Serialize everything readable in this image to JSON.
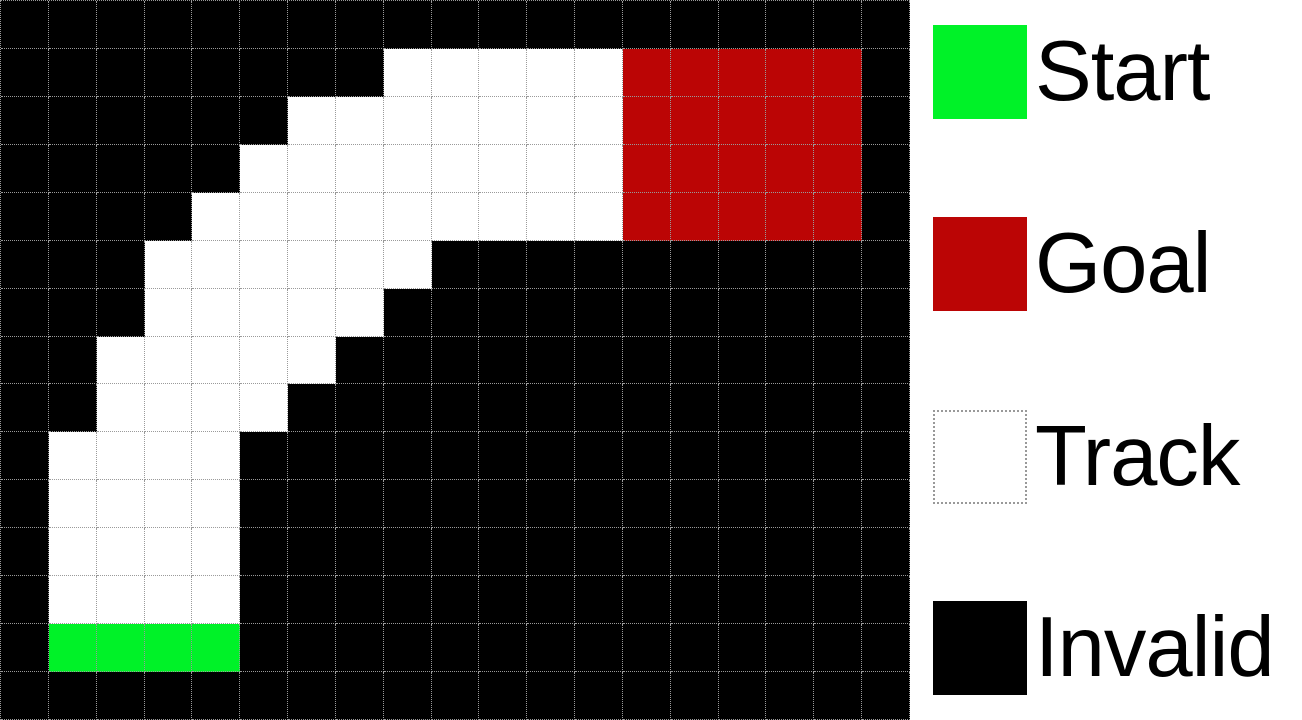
{
  "figure": {
    "type": "racetrack-gridworld",
    "grid": {
      "rows": 15,
      "cols": 19,
      "cell_size_px": 48,
      "cell_key": {
        "B": "invalid",
        "W": "track",
        "G": "start",
        "R": "goal"
      },
      "map": [
        "BBBBBBBBBBBBBBBBBBB",
        "BBBBBBBBWWWWWRRRRRB",
        "BBBBBBWWWWWWWRRRRRB",
        "BBBBBWWWWWWWWRRRRRB",
        "BBBBWWWWWWWWWRRRRRB",
        "BBBWWWWWWBBBBBBBBBB",
        "BBBWWWWWBBBBBBBBBBB",
        "BBWWWWWBBBBBBBBBBBB",
        "BBWWWWBBBBBBBBBBBBB",
        "BWWWWBBBBBBBBBBBBBB",
        "BWWWWBBBBBBBBBBBBBB",
        "BWWWWBBBBBBBBBBBBBB",
        "BWWWWBBBBBBBBBBBBBB",
        "BGGGGBBBBBBBBBBBBBB",
        "BBBBBBBBBBBBBBBBBBB"
      ]
    },
    "colors": {
      "start": "#00F228",
      "goal": "#BB0505",
      "track": "#FFFFFF",
      "invalid": "#000000",
      "gridline": "#9A9A9A",
      "track_swatch_border": "#999999",
      "legend_background": "#FFFFFF",
      "label_text": "#000000"
    },
    "legend": {
      "items": [
        {
          "label": "Start",
          "swatch": "start"
        },
        {
          "label": "Goal",
          "swatch": "goal"
        },
        {
          "label": "Track",
          "swatch": "track"
        },
        {
          "label": "Invalid",
          "swatch": "invalid"
        }
      ]
    }
  }
}
